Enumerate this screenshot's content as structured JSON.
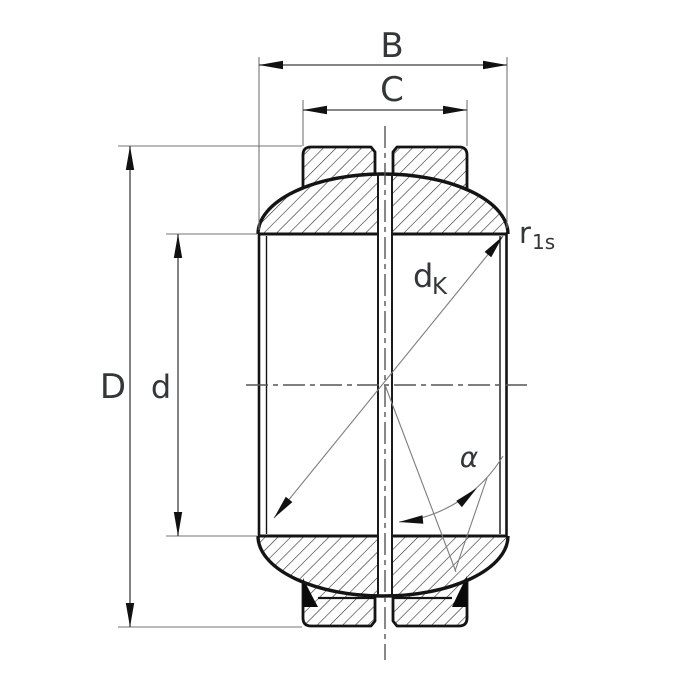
{
  "drawing": {
    "labels": {
      "inner_ring_width": "B",
      "outer_ring_width": "C",
      "outside_diameter": "D",
      "bore_diameter": "d",
      "sphere_diameter": {
        "main": "d",
        "sub": "K"
      },
      "chamfer_radius": {
        "main": "r",
        "sub": "1s"
      },
      "tilt_angle": "α"
    },
    "colors": {
      "outline": "#141414",
      "hatch": "#2e2e2e",
      "dimension_line": "#3f3f3f",
      "extension_line": "#757575",
      "construction_line": "#7d7d7d",
      "centerline": "#555555",
      "label_text": "#33373a",
      "seal_fill": "#0a0a0a",
      "background": "#ffffff"
    }
  }
}
